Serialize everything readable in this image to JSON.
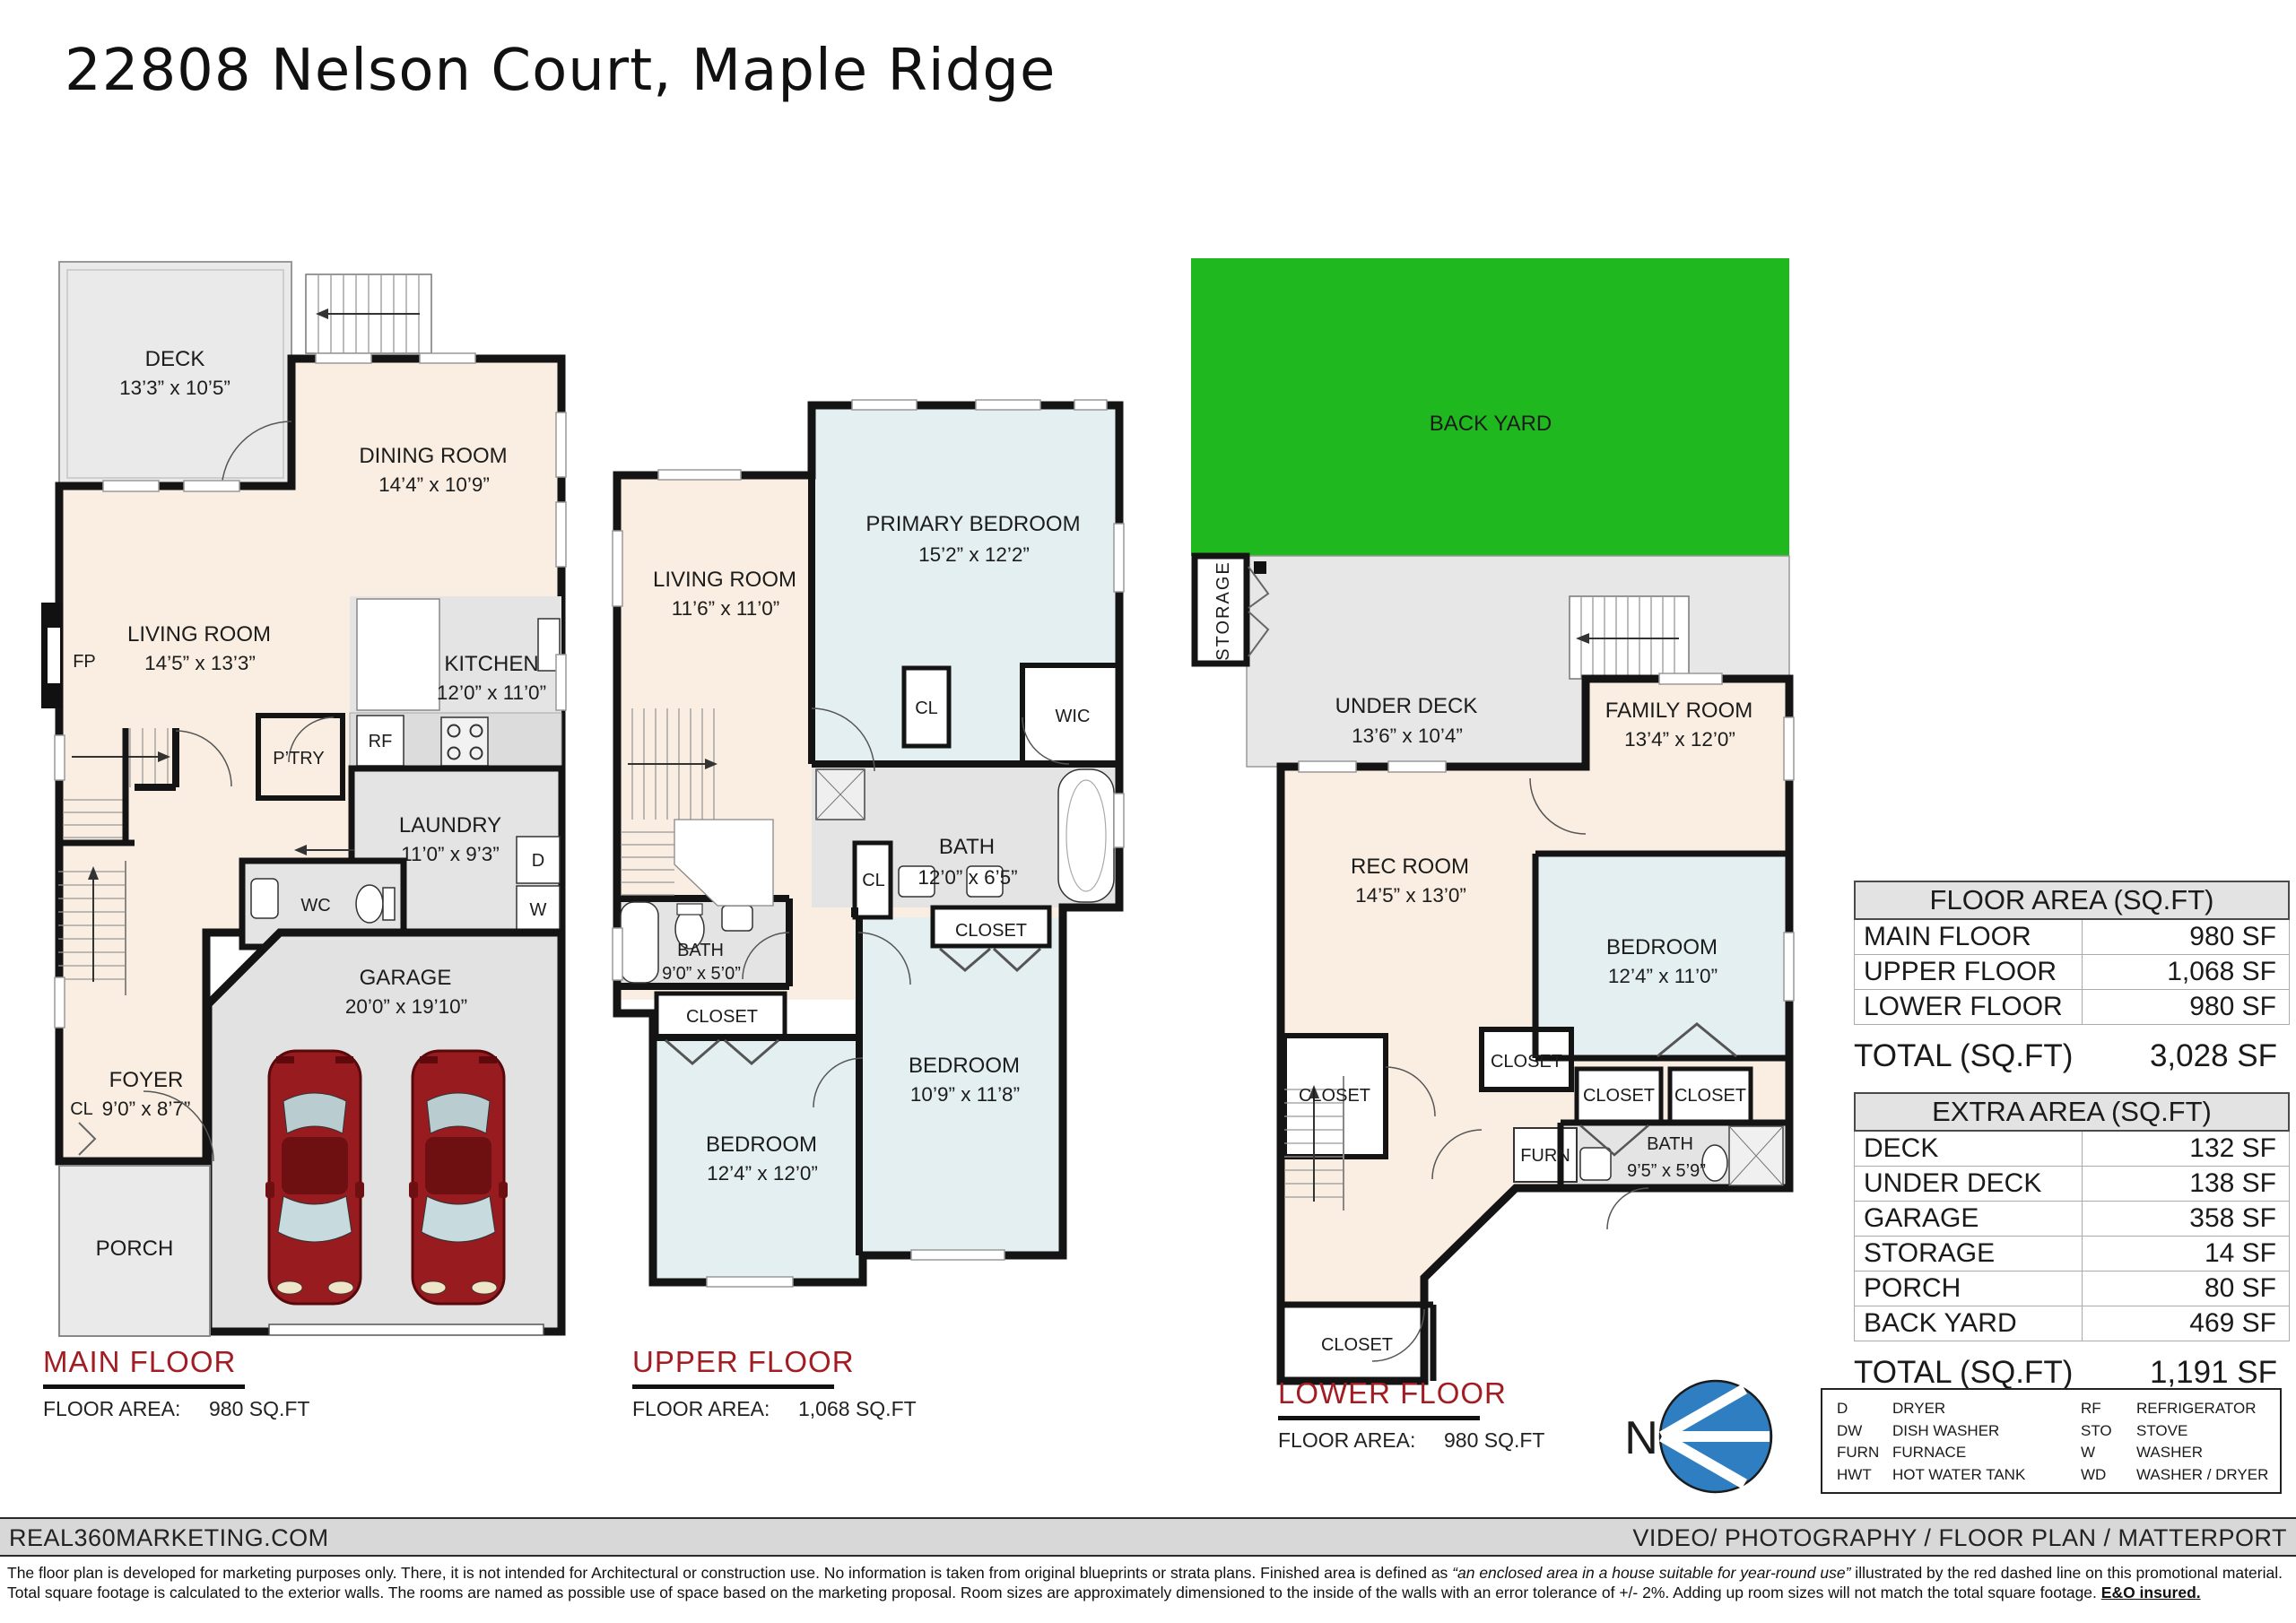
{
  "title": "22808 Nelson Court, Maple Ridge",
  "colors": {
    "accent_red": "#A21D23",
    "backyard_green": "#1FB81F",
    "compass_blue": "#2E7EC1",
    "wall_black": "#141414",
    "room_cream": "#F9EEE1",
    "room_blue": "#E3EFF1",
    "room_gray": "#E4E4E4"
  },
  "floors": {
    "main": {
      "label": "MAIN FLOOR",
      "area_label": "FLOOR AREA:",
      "area_value": "980 SQ.FT"
    },
    "upper": {
      "label": "UPPER FLOOR",
      "area_label": "FLOOR AREA:",
      "area_value": "1,068 SQ.FT"
    },
    "lower": {
      "label": "LOWER FLOOR",
      "area_label": "FLOOR AREA:",
      "area_value": "980 SQ.FT"
    }
  },
  "rooms": {
    "main": {
      "deck": {
        "name": "DECK",
        "dims": "13’3” x 10’5”"
      },
      "dining": {
        "name": "DINING ROOM",
        "dims": "14’4” x 10’9”"
      },
      "living": {
        "name": "LIVING ROOM",
        "dims": "14’5” x 13’3”"
      },
      "kitchen": {
        "name": "KITCHEN",
        "dims": "12’0” x 11’0”"
      },
      "laundry": {
        "name": "LAUNDRY",
        "dims": "11’0” x 9’3”"
      },
      "garage": {
        "name": "GARAGE",
        "dims": "20’0” x 19’10”"
      },
      "foyer": {
        "name": "FOYER",
        "dims": "9’0” x 8’7”"
      },
      "porch": "PORCH",
      "wc": "WC",
      "ptry": "P’TRY",
      "rf": "RF",
      "fp": "FP",
      "cl": "CL",
      "dryer": "D",
      "washer": "W"
    },
    "upper": {
      "living": {
        "name": "LIVING ROOM",
        "dims": "11’6” x 11’0”"
      },
      "primary": {
        "name": "PRIMARY BEDROOM",
        "dims": "15’2” x 12’2”"
      },
      "bath_main": {
        "name": "BATH",
        "dims": "12’0” x 6’5”"
      },
      "bath_hall": {
        "name": "BATH",
        "dims": "9’0” x 5’0”"
      },
      "bed_left": {
        "name": "BEDROOM",
        "dims": "12’4” x 12’0”"
      },
      "bed_right": {
        "name": "BEDROOM",
        "dims": "10’9” x 11’8”"
      },
      "closet_left": "CLOSET",
      "closet_right": "CLOSET",
      "cl_primary": "CL",
      "cl_hall": "CL",
      "wic": "WIC"
    },
    "lower": {
      "backyard": "BACK YARD",
      "storage": "STORAGE",
      "underdeck": {
        "name": "UNDER DECK",
        "dims": "13’6” x 10’4”"
      },
      "family": {
        "name": "FAMILY ROOM",
        "dims": "13’4” x 12’0”"
      },
      "rec": {
        "name": "REC ROOM",
        "dims": "14’5” x 13’0”"
      },
      "bed": {
        "name": "BEDROOM",
        "dims": "12’4” x 11’0”"
      },
      "bath": {
        "name": "BATH",
        "dims": "9’5” x 5’9”"
      },
      "furn": "FURN",
      "closet_left": "CLOSET",
      "closet_mid": "CLOSET",
      "closet_a": "CLOSET",
      "closet_b": "CLOSET",
      "closet_bottom": "CLOSET"
    }
  },
  "tables": {
    "floor_area": {
      "title": "FLOOR AREA (SQ.FT)",
      "rows": [
        {
          "label": "MAIN FLOOR",
          "value": "980 SF"
        },
        {
          "label": "UPPER FLOOR",
          "value": "1,068 SF"
        },
        {
          "label": "LOWER FLOOR",
          "value": "980 SF"
        }
      ],
      "total_label": "TOTAL (SQ.FT)",
      "total_value": "3,028 SF"
    },
    "extra_area": {
      "title": "EXTRA AREA (SQ.FT)",
      "rows": [
        {
          "label": "DECK",
          "value": "132 SF"
        },
        {
          "label": "UNDER DECK",
          "value": "138 SF"
        },
        {
          "label": "GARAGE",
          "value": "358 SF"
        },
        {
          "label": "STORAGE",
          "value": "14 SF"
        },
        {
          "label": "PORCH",
          "value": "80 SF"
        },
        {
          "label": "BACK YARD",
          "value": "469 SF"
        }
      ],
      "total_label": "TOTAL (SQ.FT)",
      "total_value": "1,191 SF"
    }
  },
  "legend": {
    "left": [
      {
        "abbr": "D",
        "label": "DRYER"
      },
      {
        "abbr": "DW",
        "label": "DISH WASHER"
      },
      {
        "abbr": "FURN",
        "label": "FURNACE"
      },
      {
        "abbr": "HWT",
        "label": "HOT WATER TANK"
      }
    ],
    "right": [
      {
        "abbr": "RF",
        "label": "REFRIGERATOR"
      },
      {
        "abbr": "STO",
        "label": "STOVE"
      },
      {
        "abbr": "W",
        "label": "WASHER"
      },
      {
        "abbr": "WD",
        "label": "WASHER / DRYER"
      }
    ]
  },
  "compass": {
    "n": "N"
  },
  "footer": {
    "left": "REAL360MARKETING.COM",
    "right": "VIDEO/ PHOTOGRAPHY / FLOOR PLAN / MATTERPORT"
  },
  "disclaimer": {
    "p1": "The floor plan is developed for marketing purposes only. There, it is not intended for Architectural or construction use. No information is  taken from original blueprints or strata plans. Finished area is defined as  ",
    "italic": "“an enclosed area in a house suitable for year-round use”",
    "p2": " illustrated by the red dashed line on this promotional material. Total square footage is calculated to the exterior walls. The rooms are named as possible use of space based on the marketing proposal. Room sizes are approximately dimensioned to the inside of the walls with an error tolerance of +/- 2%. Adding up room sizes will not match the total square footage. ",
    "bold": "E&O insured."
  }
}
